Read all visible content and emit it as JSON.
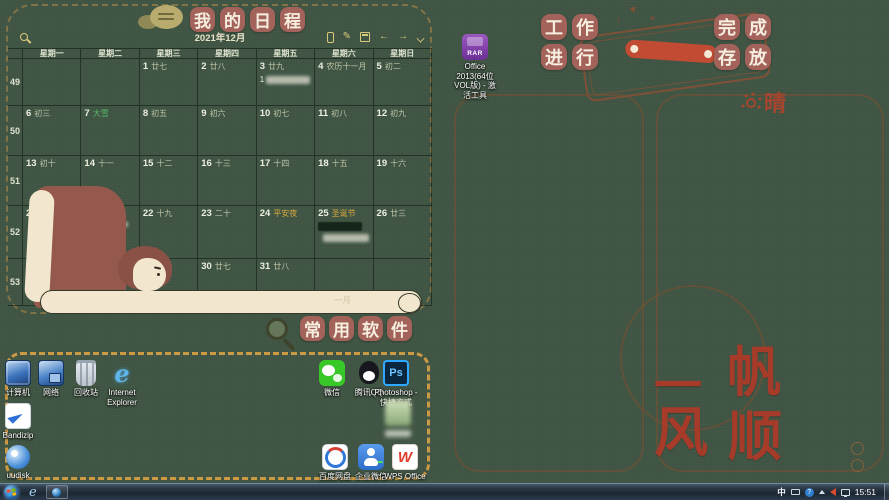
{
  "colors": {
    "background": "#3F5443",
    "badge": "#A3625A",
    "dashed_border": "#CC9A45",
    "motto_red": "#A63B2A",
    "solar_term_green": "#58B96B",
    "festival_orange": "#D9A73E",
    "toolbar_gold": "#D9C97A"
  },
  "wallpaper": {
    "schedule_title_chars": "我的日程",
    "software_title_chars": "常用软件",
    "work_label_rows": [
      "工作",
      "进行"
    ],
    "done_label_rows": [
      "完成",
      "存放"
    ],
    "weather_char": "晴",
    "motto_chars": [
      "一",
      "帆",
      "风",
      "顺"
    ],
    "january_label": "一月"
  },
  "calendar": {
    "month_title": "2021年12月",
    "weekday_headers": [
      "星期一",
      "星期二",
      "星期三",
      "星期四",
      "星期五",
      "星期六",
      "星期日"
    ],
    "toolbar_icons": [
      "search",
      "phone",
      "edit",
      "calendar-grid",
      "prev-month",
      "next-month",
      "collapse"
    ],
    "weeks": [
      {
        "num": "49",
        "days": [
          {},
          {},
          {
            "d": "1",
            "l": "廿七"
          },
          {
            "d": "2",
            "l": "廿八"
          },
          {
            "d": "3",
            "l": "廿九",
            "events": [
              {
                "kind": "light",
                "prefix": "1",
                "w": 44,
                "h": 8
              }
            ]
          },
          {
            "d": "4",
            "l": "农历十一月"
          },
          {
            "d": "5",
            "l": "初二"
          }
        ]
      },
      {
        "num": "50",
        "days": [
          {
            "d": "6",
            "l": "初三"
          },
          {
            "d": "7",
            "l": "大雪",
            "c": "green"
          },
          {
            "d": "8",
            "l": "初五"
          },
          {
            "d": "9",
            "l": "初六"
          },
          {
            "d": "10",
            "l": "初七"
          },
          {
            "d": "11",
            "l": "初八"
          },
          {
            "d": "12",
            "l": "初九"
          }
        ]
      },
      {
        "num": "51",
        "days": [
          {
            "d": "13",
            "l": "初十"
          },
          {
            "d": "14",
            "l": "十一"
          },
          {
            "d": "15",
            "l": "十二"
          },
          {
            "d": "16",
            "l": "十三"
          },
          {
            "d": "17",
            "l": "十四"
          },
          {
            "d": "18",
            "l": "十五"
          },
          {
            "d": "19",
            "l": "十六"
          }
        ]
      },
      {
        "num": "52",
        "days": [
          {
            "d": "20",
            "l": "十七"
          },
          {
            "d": "21",
            "l": "冬至",
            "c": "green",
            "events": [
              {
                "kind": "light",
                "w": 44,
                "h": 5
              },
              {
                "kind": "red",
                "w": 40,
                "h": 8
              }
            ]
          },
          {
            "d": "22",
            "l": "十九"
          },
          {
            "d": "23",
            "l": "二十"
          },
          {
            "d": "24",
            "l": "平安夜",
            "c": "orange"
          },
          {
            "d": "25",
            "l": "圣诞节",
            "c": "orange",
            "events": [
              {
                "kind": "dark",
                "w": 44,
                "h": 9
              },
              {
                "kind": "light",
                "w": 46,
                "h": 8,
                "ml": 5
              }
            ]
          },
          {
            "d": "26",
            "l": "廿三"
          }
        ]
      },
      {
        "num": "53",
        "days": [
          {
            "d": "27",
            "l": "廿四"
          },
          {
            "d": "28",
            "l": "廿五"
          },
          {
            "d": "29",
            "l": "廿六"
          },
          {
            "d": "30",
            "l": "廿七"
          },
          {
            "d": "31",
            "l": "廿八"
          },
          {},
          {}
        ]
      }
    ]
  },
  "desktop_icons": {
    "items": [
      {
        "kind": "computer",
        "label": "计算机",
        "x": -2,
        "y": 360
      },
      {
        "kind": "network",
        "label": "网络",
        "x": 31,
        "y": 360
      },
      {
        "kind": "recycle",
        "label": "回收站",
        "x": 66,
        "y": 360
      },
      {
        "kind": "ie",
        "glyph": "e",
        "lines": [
          "Internet",
          "Explorer"
        ],
        "x": 102,
        "y": 360
      },
      {
        "kind": "bandizip",
        "label": "Bandizip",
        "x": -2,
        "y": 403
      },
      {
        "kind": "disk",
        "label": "uudisk",
        "x": -2,
        "y": 445
      },
      {
        "kind": "wechat",
        "label": "微信",
        "x": 312,
        "y": 360
      },
      {
        "kind": "qq",
        "label": "腾讯QQ",
        "x": 349,
        "y": 360
      },
      {
        "kind": "ps",
        "glyph": "Ps",
        "lines": [
          "Photoshop -",
          "快捷方式"
        ],
        "x": 376,
        "y": 360
      },
      {
        "kind": "blurred",
        "blur_label": true,
        "x": 378,
        "y": 400
      },
      {
        "kind": "baidu",
        "label": "百度网盘",
        "x": 315,
        "y": 444
      },
      {
        "kind": "wecom",
        "label": "企业微信",
        "x": 351,
        "y": 444
      },
      {
        "kind": "wps",
        "glyph": "W",
        "label": "WPS Office",
        "x": 385,
        "y": 444
      },
      {
        "kind": "rar",
        "glyph": "RAR",
        "lines": [
          "Office",
          "2013(64位",
          "VOL版) - 激",
          "活工具"
        ],
        "x": 455,
        "y": 34
      }
    ]
  },
  "taskbar": {
    "input_indicator": "中",
    "clock": "15:51"
  }
}
